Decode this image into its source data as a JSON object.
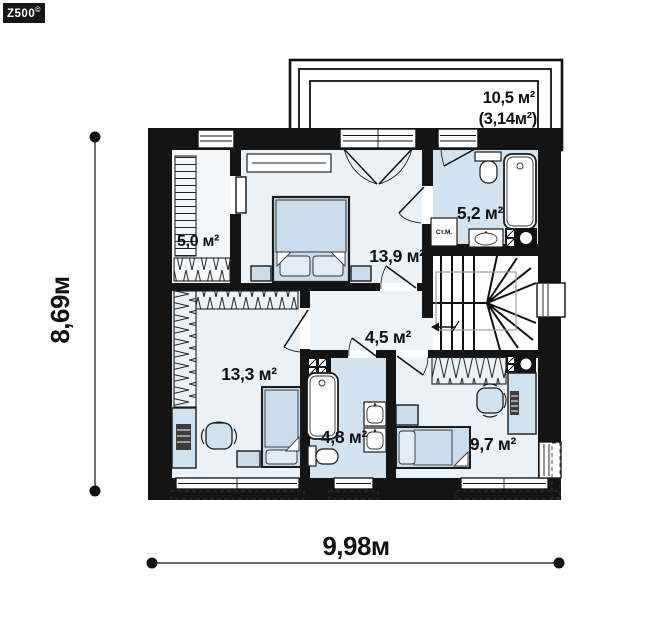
{
  "logo": {
    "text": "Z500",
    "mark": "©"
  },
  "dimensions": {
    "width": "9,98м",
    "height": "8,69м"
  },
  "balcony": {
    "area": "10,5 м²",
    "area_secondary": "(3,14м²)"
  },
  "rooms": {
    "wardrobe": {
      "area": "5,0 м²"
    },
    "bedroom_top": {
      "area": "13,9 м²"
    },
    "bathroom_top": {
      "area": "5,2 м²",
      "washing_machine": "Ст.М."
    },
    "hallway": {
      "area": "4,5 м²"
    },
    "bedroom_left": {
      "area": "13,3 м²"
    },
    "bathroom_bottom": {
      "area": "4,8 м²"
    },
    "bedroom_right": {
      "area": "9,7 м²"
    }
  },
  "colors": {
    "wall": "#141414",
    "room_floor": "#eaf1f7",
    "bathroom_floor": "#d2e3f1",
    "hall_floor": "#eef3f8",
    "wardrobe_floor": "#f6f9fc",
    "furniture": "#c8dcec",
    "accent_light": "#e2ecf5"
  }
}
